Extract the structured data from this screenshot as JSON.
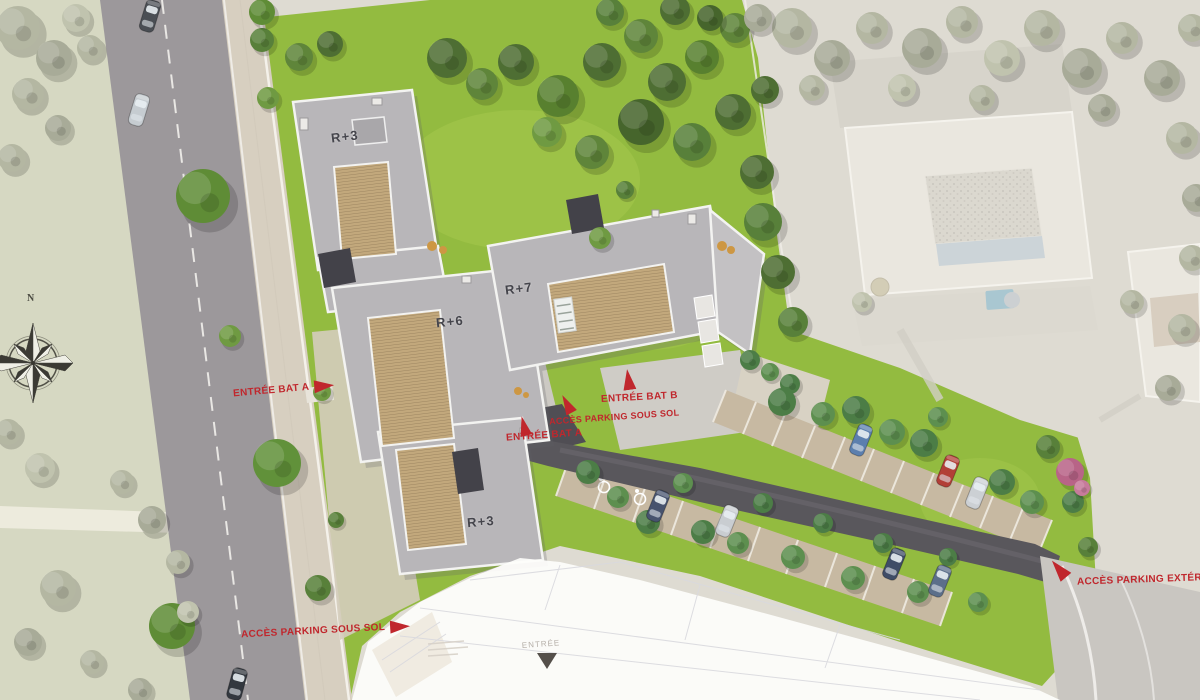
{
  "plan": {
    "building_levels": {
      "bat_a_top": "R+3",
      "bat_a_mid": "R+6",
      "bat_b": "R+7",
      "bat_a_bottom": "R+3"
    },
    "annotations": {
      "entree_bat_a_street": "ENTRÉE BAT A",
      "entree_bat_b": "ENTRÉE BAT B",
      "acces_parking_sous_sol_center": "ACCÈS PARKING SOUS SOL",
      "entree_bat_a_courtyard": "ENTRÉE BAT A",
      "acces_parking_sous_sol_street": "ACCÈS PARKING SOUS SOL",
      "acces_parking_exterieur": "ACCÈS PARKING EXTÉRIEUR"
    },
    "compass": {
      "north": "N"
    },
    "floorplan": {
      "entrance": "ENTRÉE"
    },
    "colors": {
      "annotation_red": "#c0272d",
      "lawn_green": "#93bb40",
      "roof_grey": "#b8b6b9",
      "deck_wood": "#c2a87c",
      "driveway_asphalt": "#59575c",
      "context_desaturated": "#dedbd2"
    }
  }
}
